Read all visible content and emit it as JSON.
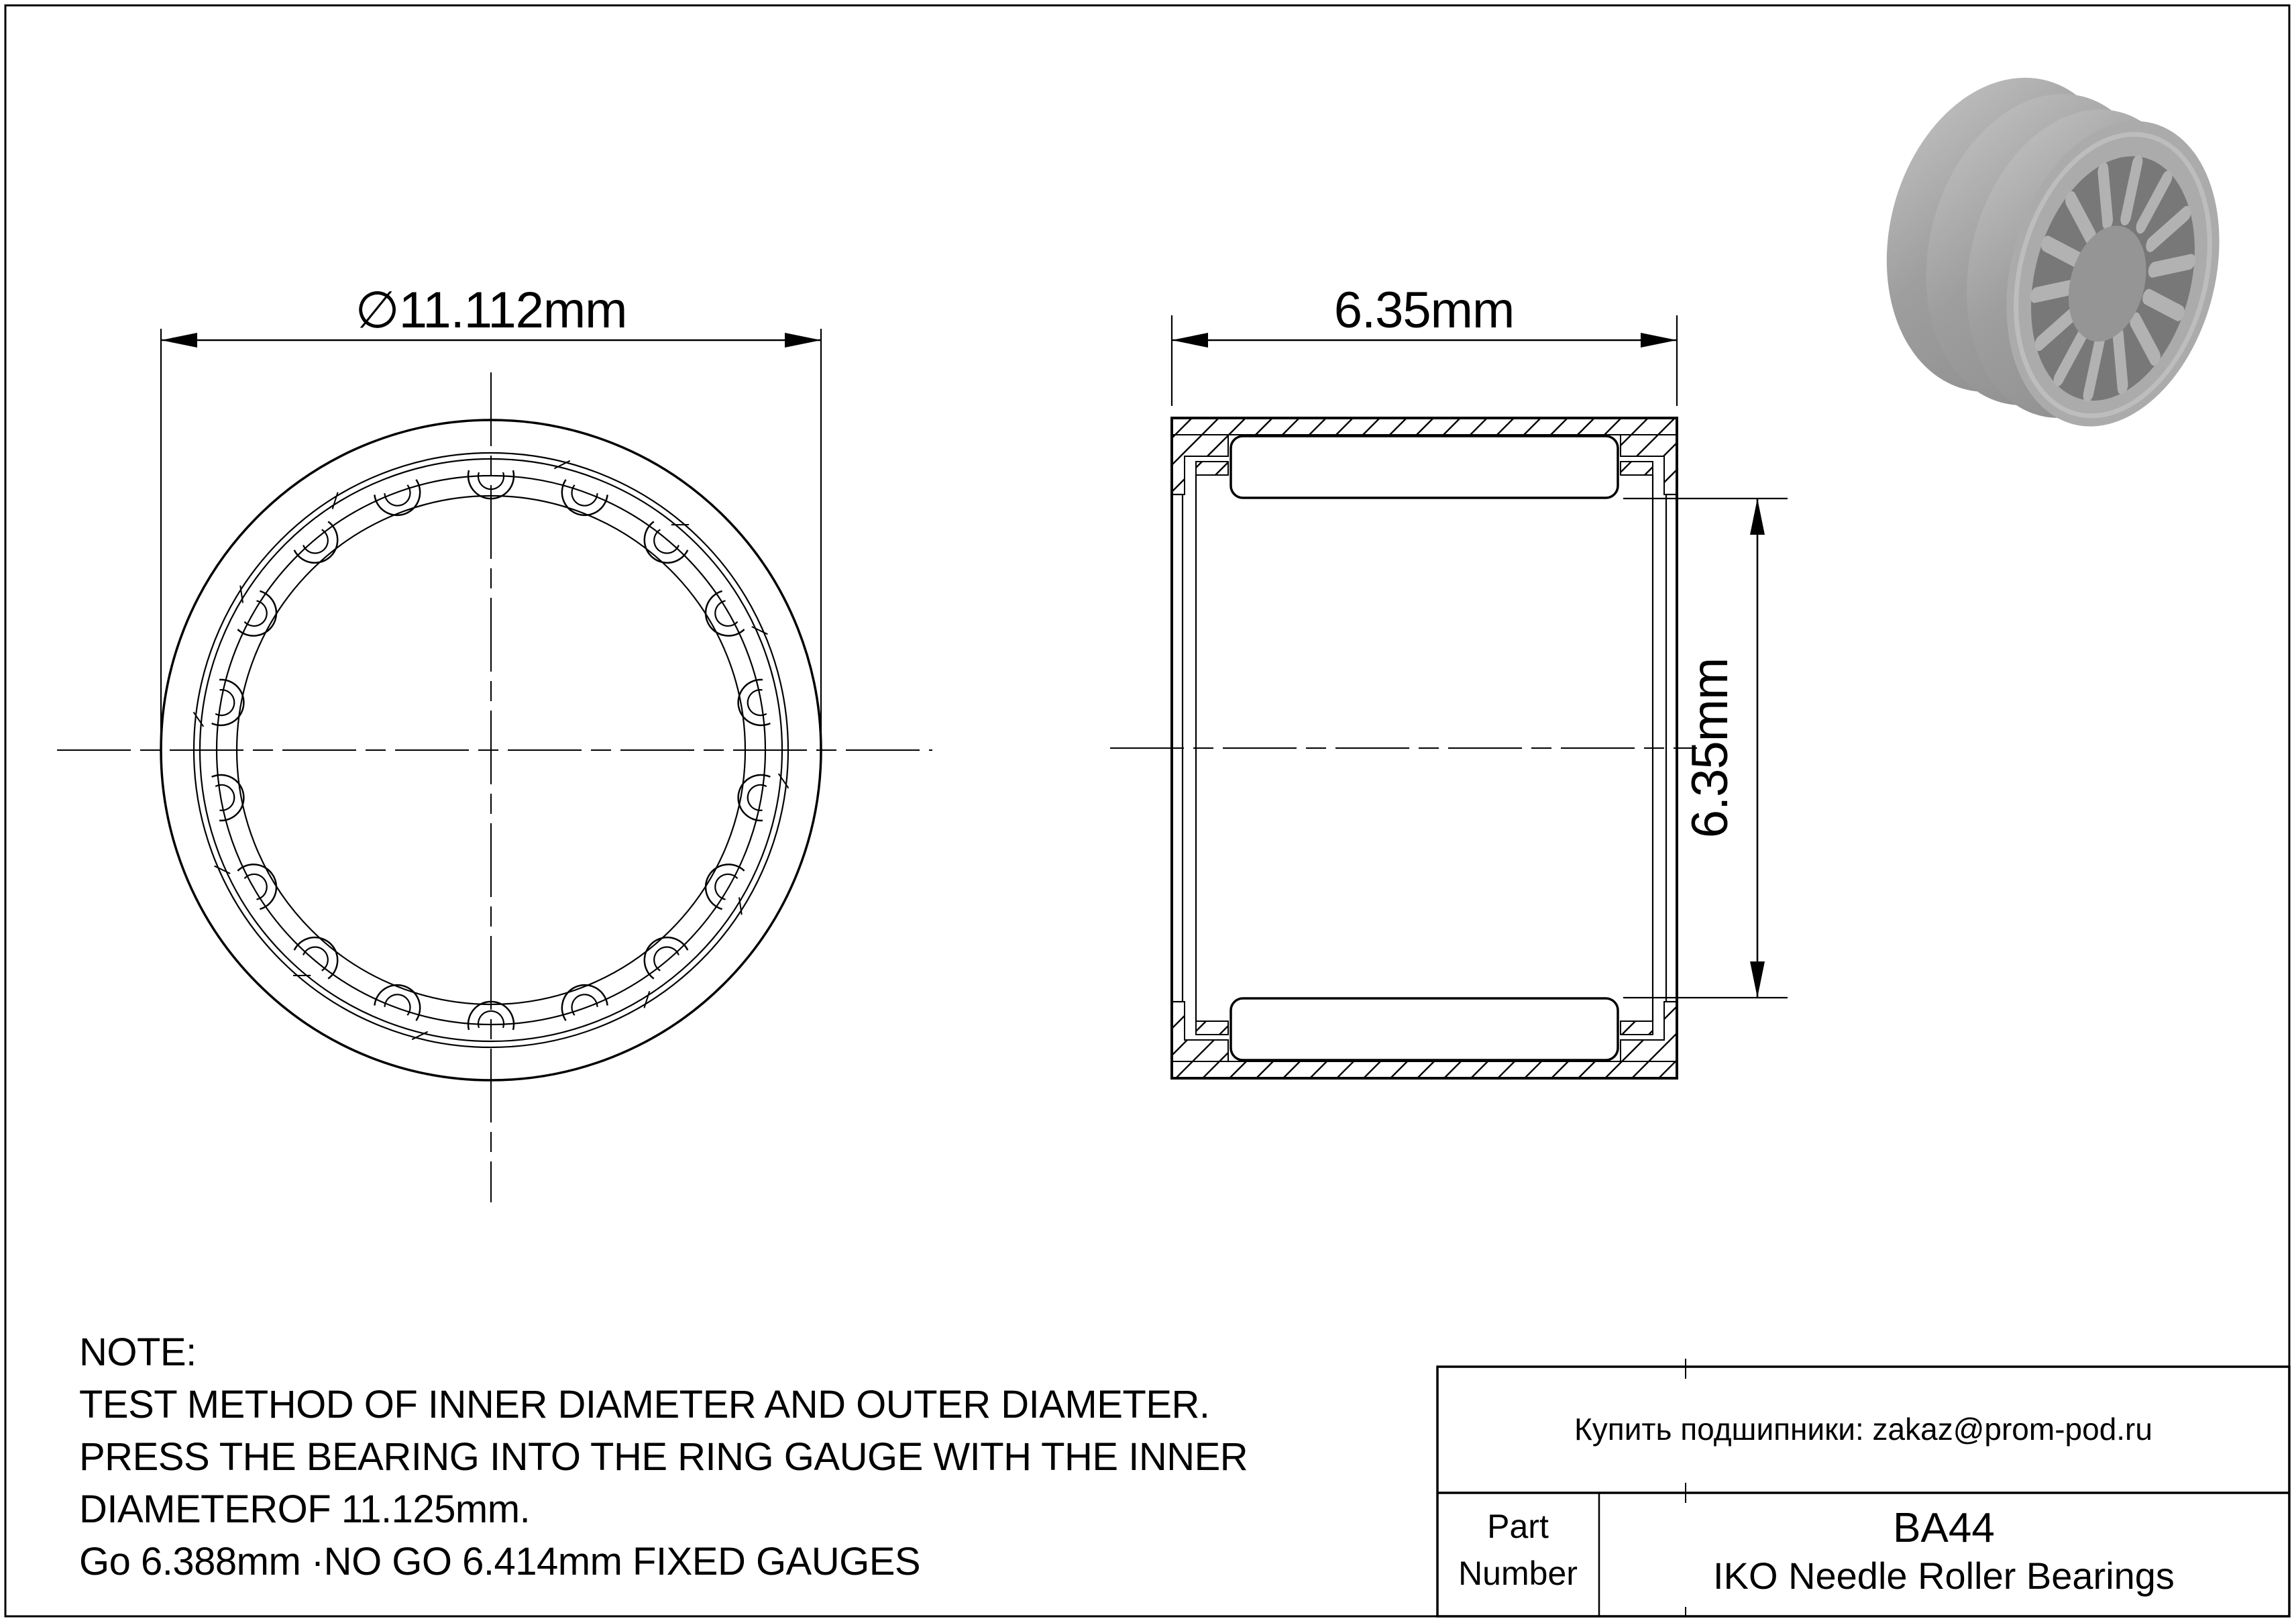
{
  "page": {
    "background": "#ffffff",
    "line_color": "#000000"
  },
  "front_view": {
    "diameter_label": "∅11.112mm",
    "roller_count": 18
  },
  "section_view": {
    "width_label": "6.35mm",
    "bore_label": "6.35mm"
  },
  "photo": {
    "body_color": "#9a9a9a",
    "highlight_color": "#c6c6c6",
    "face_color": "#ababab",
    "bore_color": "#787878",
    "roller_color": "#b2b2b2",
    "far_wall_color": "#959595",
    "roller_count": 14
  },
  "note": {
    "title": "NOTE:",
    "lines": [
      "TEST METHOD OF INNER DIAMETER AND OUTER DIAMETER.",
      "PRESS THE BEARING INTO THE RING GAUGE WITH THE INNER",
      "DIAMETEROF 11.125mm.",
      "Go 6.388mm ·NO GO 6.414mm FIXED GAUGES"
    ]
  },
  "title_block": {
    "supplier_note": "Купить подшипники: zakaz@prom-pod.ru",
    "part_label_line1": "Part",
    "part_label_line2": "Number",
    "part_number": "BA44",
    "description": "IKO Needle Roller Bearings"
  }
}
